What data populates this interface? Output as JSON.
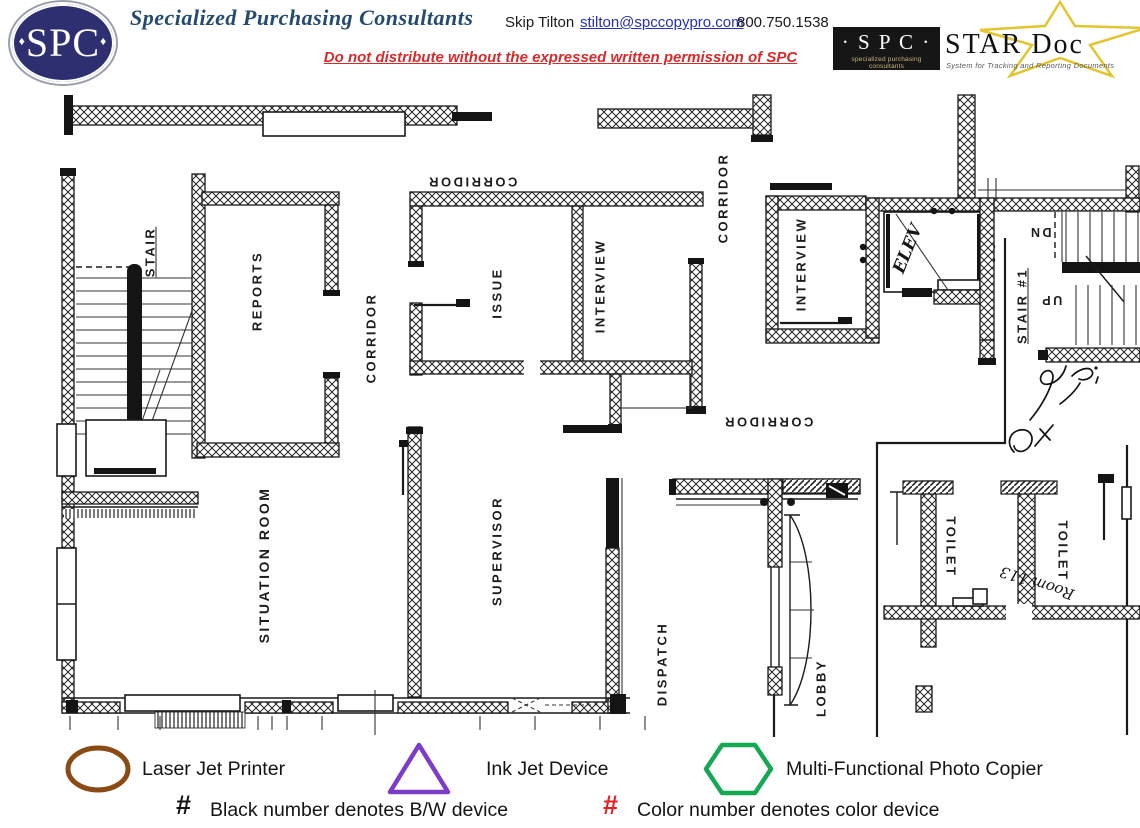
{
  "header": {
    "logo_text": "SPC",
    "logo_diamond": "♦",
    "company": "Specialized Purchasing Consultants",
    "contact_name": "Skip Tilton",
    "email": "stilton@spccopypro.com",
    "phone": "800.750.1538",
    "warning": "Do not distribute without the expressed written permission of SPC",
    "star_doc": {
      "box_title": "· S P C ·",
      "box_subtitle": "specialized purchasing consultants",
      "title": "STAR Doc",
      "subtitle": "System for Tracking and Reporting Documents"
    }
  },
  "floor_plan": {
    "rooms": [
      {
        "label": "STAIR"
      },
      {
        "label": "REPORTS"
      },
      {
        "label": "CORRIDOR"
      },
      {
        "label": "CORRIDOR"
      },
      {
        "label": "ISSUE"
      },
      {
        "label": "INTERVIEW"
      },
      {
        "label": "CORRIDOR"
      },
      {
        "label": "INTERVIEW"
      },
      {
        "label": "STAIR #1"
      },
      {
        "label": "CORRIDOR"
      },
      {
        "label": "SITUATION ROOM"
      },
      {
        "label": "SUPERVISOR"
      },
      {
        "label": "DISPATCH"
      },
      {
        "label": "LOBBY"
      },
      {
        "label": "TOILET"
      },
      {
        "label": "TOILET"
      }
    ],
    "annotations": {
      "elevator": "ELEV",
      "stair_down": "DN",
      "stair_up": "UP",
      "handwritten_room": "Room 113"
    }
  },
  "legend": {
    "items": [
      {
        "shape": "ellipse",
        "color": "#8b4a14",
        "label": "Laser Jet Printer"
      },
      {
        "shape": "triangle",
        "color": "#7c3bc8",
        "label": "Ink Jet Device"
      },
      {
        "shape": "hexagon",
        "color": "#14a853",
        "label": "Multi-Functional Photo Copier"
      }
    ],
    "notes": [
      {
        "symbol": "#",
        "color": "#141414",
        "label": "Black number denotes B/W device"
      },
      {
        "symbol": "#",
        "color": "#e51f1f",
        "label": "Color number denotes color device"
      }
    ]
  }
}
